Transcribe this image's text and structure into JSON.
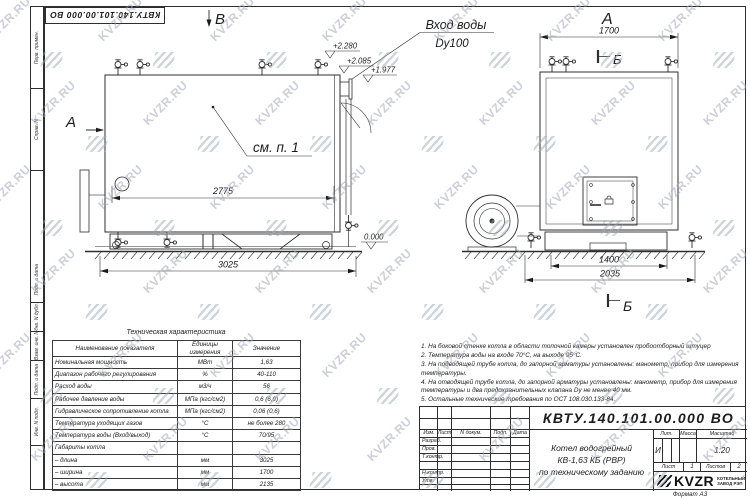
{
  "watermark": {
    "text": "KVZR.RU"
  },
  "stamp": {
    "doc_number": "КВТУ.140.101.00.000  ВО"
  },
  "margin": {
    "top_labels": [
      "Перв. примен.",
      "Справ. N"
    ],
    "bottom_labels": [
      "Подп. и дата",
      "Инв. N дубл.",
      "Взам. инв. N",
      "Подп. и дата",
      "Инв. N подл."
    ]
  },
  "views": {
    "marker_v": "В",
    "marker_a_side": "А",
    "inlet_title": "Вход воды",
    "inlet_size": "Dy100",
    "see_note": "см. п. 1",
    "elev_top": "+2.280",
    "elev_mid": "+2.085",
    "elev_low": "+1.977",
    "elev_zero": "0.000",
    "dim_inner_width": "2775",
    "dim_outer_width": "3025",
    "marker_a_front": "А",
    "dim_front_top": "1700",
    "marker_b_top": "Б",
    "marker_b_bottom": "Б",
    "dim_front_inner": "1400",
    "dim_front_outer": "2035"
  },
  "tech_table": {
    "title": "Техническая характеристика",
    "headers": [
      "Наименование показателя",
      "Единицы измерения",
      "Значение"
    ],
    "rows": [
      [
        "Номинальная мощность",
        "МВт",
        "1,63"
      ],
      [
        "Диапазон рабочего регулирования",
        "%",
        "40-110"
      ],
      [
        "Расход воды",
        "м3/ч",
        "56"
      ],
      [
        "Рабочее давление воды",
        "МПа (кгс/см2)",
        "0,6 (6,0)"
      ],
      [
        "Гидравлическое сопротивление котла",
        "МПа (кгс/см2)",
        "0,06 (0,6)"
      ],
      [
        "Температура уходящих газов",
        "°С",
        "не более 280"
      ],
      [
        "Температура воды (Вход/выход)",
        "°С",
        "70/95"
      ],
      [
        "Габариты котла",
        "",
        ""
      ],
      [
        "– длина",
        "мм",
        "3025"
      ],
      [
        "– ширина",
        "мм",
        "1700"
      ],
      [
        "– высота",
        "мм",
        "2135"
      ]
    ]
  },
  "notes": {
    "items": [
      "1.  На боковой стенке котла в области топочной камеры установлен пробоотборный штуцер",
      "2.  Температура воды на входе 70°С, на выходе 95°С.",
      "3.  На подводящей трубе котла, до запорной арматуры установлены: манометр, прибор для измерения температуры.",
      "4.  На отводящей трубе котла, до запорной арматуры установлены: манометр, прибор для измерения температуры и два предохранительных клапана Dу не менее 40 мм.",
      "5.  Остальные технические требования по ОСТ 108.030.133-84."
    ]
  },
  "title_block": {
    "doc_number": "КВТУ.140.101.00.000  ВО",
    "rev_headers": [
      "Изм.",
      "Лист",
      "N докум.",
      "Подп.",
      "Дата"
    ],
    "sign_rows": [
      "Разраб.",
      "Пров.",
      "Т.контр.",
      "Н.контр.",
      "Утв."
    ],
    "name_lines": [
      "Котел водогрейный",
      "КВ-1,63  КБ  (РВР)",
      "по техническому заданию"
    ],
    "lit_label": "Лит.",
    "mass_label": "Масса",
    "scale_label": "Масштаб",
    "lit_value": "И",
    "scale_value": "1:20",
    "sheet_label": "Лист",
    "sheet_value": "1",
    "sheets_label": "Листов",
    "sheets_value": "2",
    "logo_text": "KVZR",
    "logo_sub": [
      "КОТЕЛЬНЫЙ",
      "ЗАВОД РЭП"
    ],
    "format_label": "Формат   А3"
  }
}
